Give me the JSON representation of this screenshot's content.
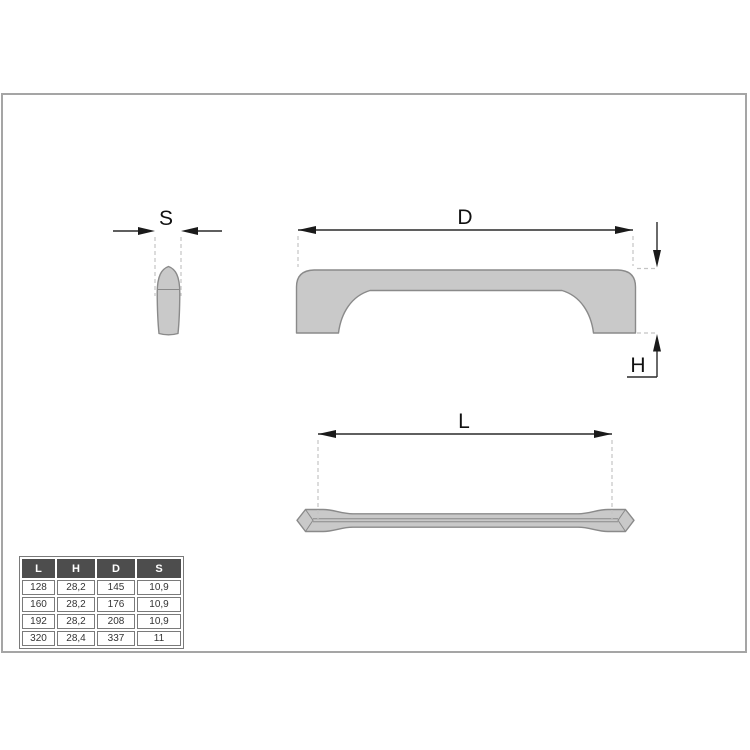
{
  "drawing": {
    "type": "technical-drawing-cabinet-handle",
    "labels": {
      "s": "S",
      "d": "D",
      "h": "H",
      "l": "L"
    }
  },
  "table": {
    "headers": [
      "L",
      "H",
      "D",
      "S"
    ],
    "rows": [
      [
        "128",
        "28,2",
        "145",
        "10,9"
      ],
      [
        "160",
        "28,2",
        "176",
        "10,9"
      ],
      [
        "192",
        "28,2",
        "208",
        "10,9"
      ],
      [
        "320",
        "28,4",
        "337",
        "11"
      ]
    ]
  },
  "colors": {
    "background": "#ffffff",
    "frame_border": "#a5a5a5",
    "handle_fill": "#c9c9c9",
    "handle_outline": "#8a8a8a",
    "dimension_line": "#2a2a2a",
    "arrow_fill": "#1a1a1a",
    "dashed_line": "#c4c4c4",
    "table_header_bg": "#4d4d4d",
    "table_header_text": "#ffffff",
    "table_border": "#7a7a7a",
    "table_text": "#333333",
    "label_text": "#111111"
  }
}
